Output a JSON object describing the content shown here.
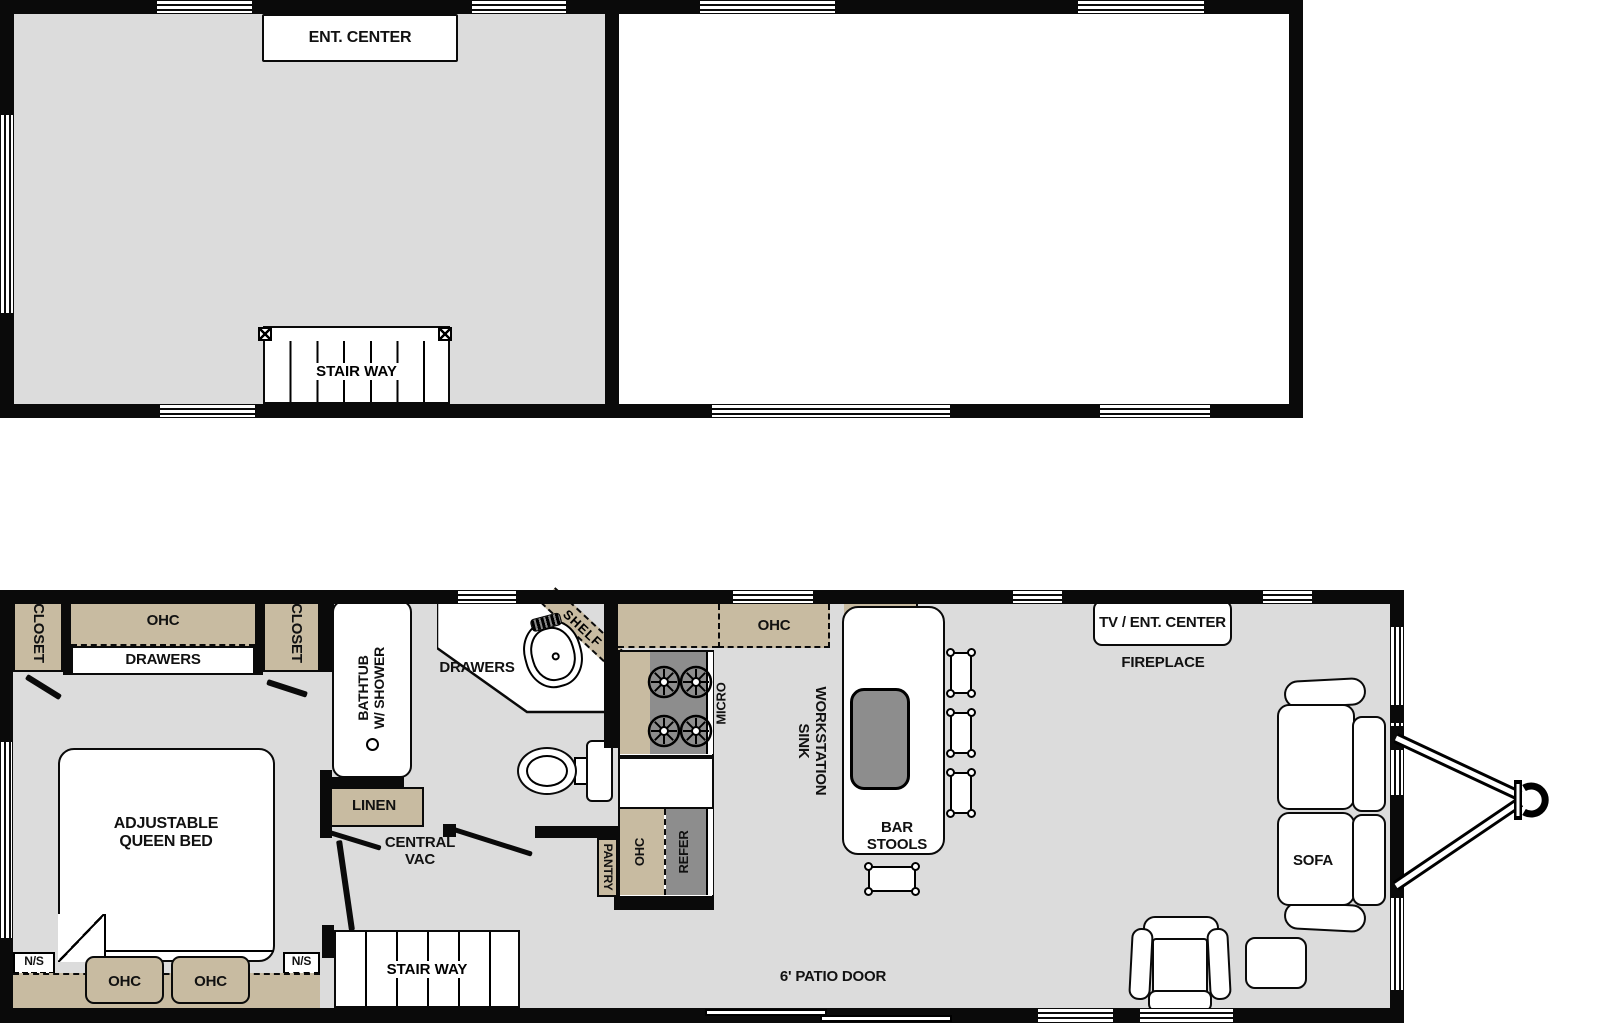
{
  "colors": {
    "wall": "#0a0a0a",
    "floor": "#dcdcdc",
    "cabinet": "#c8bba1",
    "appliance": "#8d8d8d",
    "fixture": "#ffffff"
  },
  "upper_floor": {
    "ent_center": "ENT. CENTER",
    "stairway": "STAIR WAY"
  },
  "main_floor": {
    "bedroom": {
      "closet_left": "CLOSET",
      "closet_right": "CLOSET",
      "ohc": "OHC",
      "drawers": "DRAWERS",
      "bed": {
        "line1": "ADJUSTABLE",
        "line2": "QUEEN BED"
      },
      "nightstand_left": "N/S",
      "nightstand_right": "N/S",
      "ohc_bottom_left": "OHC",
      "ohc_bottom_right": "OHC"
    },
    "bathroom": {
      "bathtub": {
        "line1": "BATHTUB",
        "line2": "W/ SHOWER"
      },
      "drawers": "DRAWERS",
      "shelf": "SHELF",
      "linen": "LINEN",
      "central_vac": {
        "line1": "CENTRAL",
        "line2": "VAC"
      }
    },
    "kitchen": {
      "ohc_overhead": "OHC",
      "micro": "MICRO",
      "pantry": "PANTRY",
      "ohc_side": "OHC",
      "refer": "REFER",
      "island": {
        "line1": "WORKSTATION",
        "line2": "SINK"
      },
      "bar_stools": {
        "line1": "BAR",
        "line2": "STOOLS"
      }
    },
    "living": {
      "tv_ent_center": "TV / ENT. CENTER",
      "fireplace": "FIREPLACE",
      "sofa": "SOFA"
    },
    "stairway": "STAIR WAY",
    "patio_door": "6' PATIO DOOR"
  }
}
